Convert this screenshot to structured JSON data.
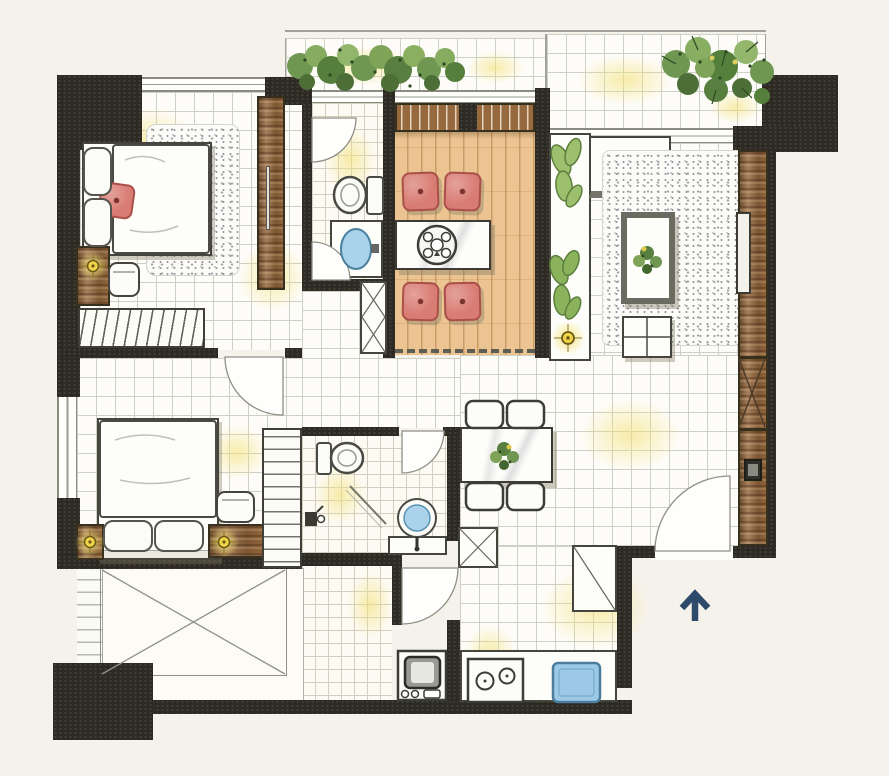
{
  "canvas": {
    "width": 889,
    "height": 776,
    "background": "#f5f2eb"
  },
  "legend": {
    "drawing_type": "residential apartment floor plan",
    "rendering_style": "hand-drawn watercolor",
    "visible_text": "none"
  },
  "palette": {
    "wall": "#2c2a23",
    "tile_floor": "#fdfcf8",
    "tile_line": "#cdd0c4",
    "tatami_wood": "#ebc491",
    "cabinet_wood": "#97693e",
    "cushion_red": "#d97d74",
    "lamp_yellow": "#f2d44a",
    "water_blue": "#aad2ea",
    "plant_green": "#6f9752",
    "compass_navy": "#2e4a6b",
    "wash_yellow": "#f3e176"
  },
  "compass": {
    "type": "entry-direction-arrow",
    "direction": "up",
    "color": "#2e4a6b"
  },
  "rooms": [
    {
      "name": "master-bedroom",
      "furniture": [
        "double-bed",
        "red-throw-pillow",
        "shag-rug",
        "nightstand",
        "table-lamp",
        "armchair",
        "hanging-closet",
        "tall-wardrobe"
      ]
    },
    {
      "name": "master-bathroom",
      "furniture": [
        "toilet",
        "vanity-sink",
        "swing-door",
        "swing-door"
      ]
    },
    {
      "name": "tatami-room",
      "furniture": [
        "hanging-closet",
        "low-tea-table",
        "tea-tray",
        "floor-cushion",
        "floor-cushion",
        "floor-cushion",
        "floor-cushion",
        "sliding-partition"
      ]
    },
    {
      "name": "living-room",
      "furniture": [
        "l-shaped-sofa",
        "side-console",
        "potted-leaves",
        "shag-rug",
        "coffee-table",
        "table-plant",
        "ottoman",
        "floor-lamp",
        "tv-cabinet",
        "television"
      ]
    },
    {
      "name": "dining-area",
      "furniture": [
        "dining-table",
        "dining-chair",
        "dining-chair",
        "dining-chair",
        "dining-chair",
        "centerpiece-plant"
      ]
    },
    {
      "name": "second-bedroom",
      "furniture": [
        "double-bed",
        "pillow",
        "pillow",
        "nightstand",
        "table-lamp",
        "nightstand",
        "table-lamp",
        "armchair",
        "wardrobe"
      ]
    },
    {
      "name": "second-bathroom",
      "furniture": [
        "toilet",
        "round-basin",
        "vanity-counter",
        "shower-mixer",
        "glass-screen"
      ]
    },
    {
      "name": "kitchen",
      "furniture": [
        "counter",
        "two-burner-stove",
        "kitchen-sink",
        "washer-appliance"
      ]
    },
    {
      "name": "entry-foyer",
      "furniture": [
        "entrance-door",
        "shoe-cabinet",
        "service-shaft"
      ]
    },
    {
      "name": "front-balcony",
      "furniture": [
        "planter-hedge"
      ]
    },
    {
      "name": "living-balcony",
      "furniture": [
        "potted-plants"
      ]
    },
    {
      "name": "utility-balcony",
      "furniture": [
        "open-deck-x-mark",
        "louver-window"
      ]
    },
    {
      "name": "hallway",
      "furniture": []
    }
  ],
  "symbols": {
    "door_swings": 6,
    "service_shafts": 4,
    "window_bands": 4,
    "lamps": 4,
    "entry_arrow": 1
  }
}
